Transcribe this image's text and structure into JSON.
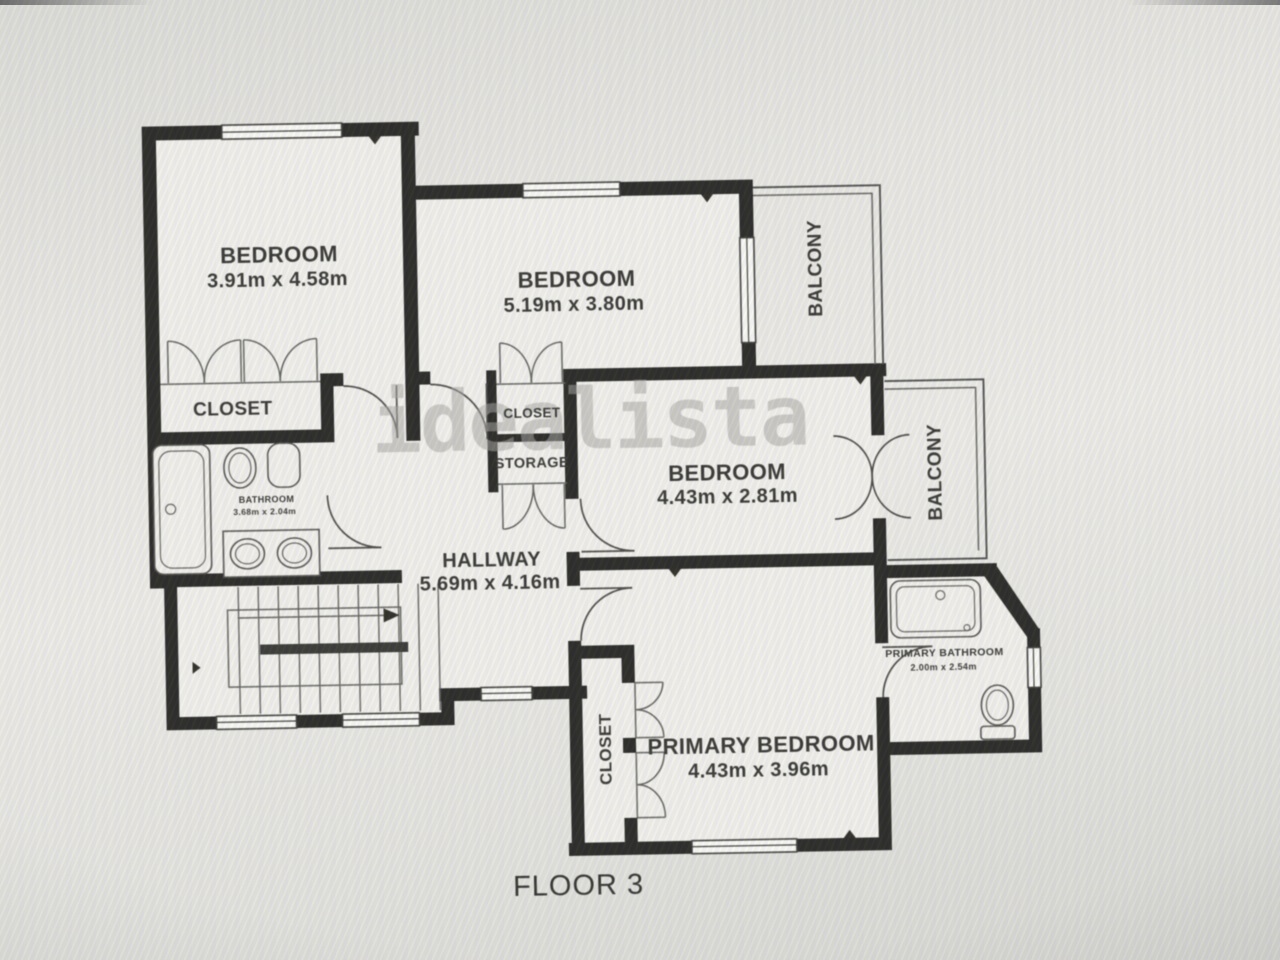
{
  "plan": {
    "floor_label": "FLOOR 3",
    "watermark": "idealista",
    "rooms": {
      "bedroom_top_left": {
        "label": "BEDROOM",
        "dims": "3.91m x 4.58m"
      },
      "bedroom_top_middle": {
        "label": "BEDROOM",
        "dims": "5.19m x 3.80m"
      },
      "bedroom_middle_right": {
        "label": "BEDROOM",
        "dims": "4.43m x 2.81m"
      },
      "primary_bedroom": {
        "label": "PRIMARY BEDROOM",
        "dims": "4.43m x 3.96m"
      },
      "hallway": {
        "label": "HALLWAY",
        "dims": "5.69m x 4.16m"
      },
      "bathroom": {
        "label": "BATHROOM",
        "dims": "3.68m x 2.04m"
      },
      "primary_bathroom": {
        "label": "PRIMARY BATHROOM",
        "dims": "2.00m x 2.54m"
      },
      "closet_top_left": {
        "label": "CLOSET"
      },
      "closet_middle": {
        "label": "CLOSET"
      },
      "storage": {
        "label": "STORAGE"
      },
      "closet_primary": {
        "label": "CLOSET"
      },
      "balcony_top": {
        "label": "BALCONY"
      },
      "balcony_middle": {
        "label": "BALCONY"
      }
    },
    "colors": {
      "wall": "#1d1c1a",
      "floor": "#f2f0ec",
      "background": "#e7e5e1",
      "label": "#2b2a27",
      "watermark": "#a3a19d",
      "line": "#4a4a4a"
    }
  }
}
